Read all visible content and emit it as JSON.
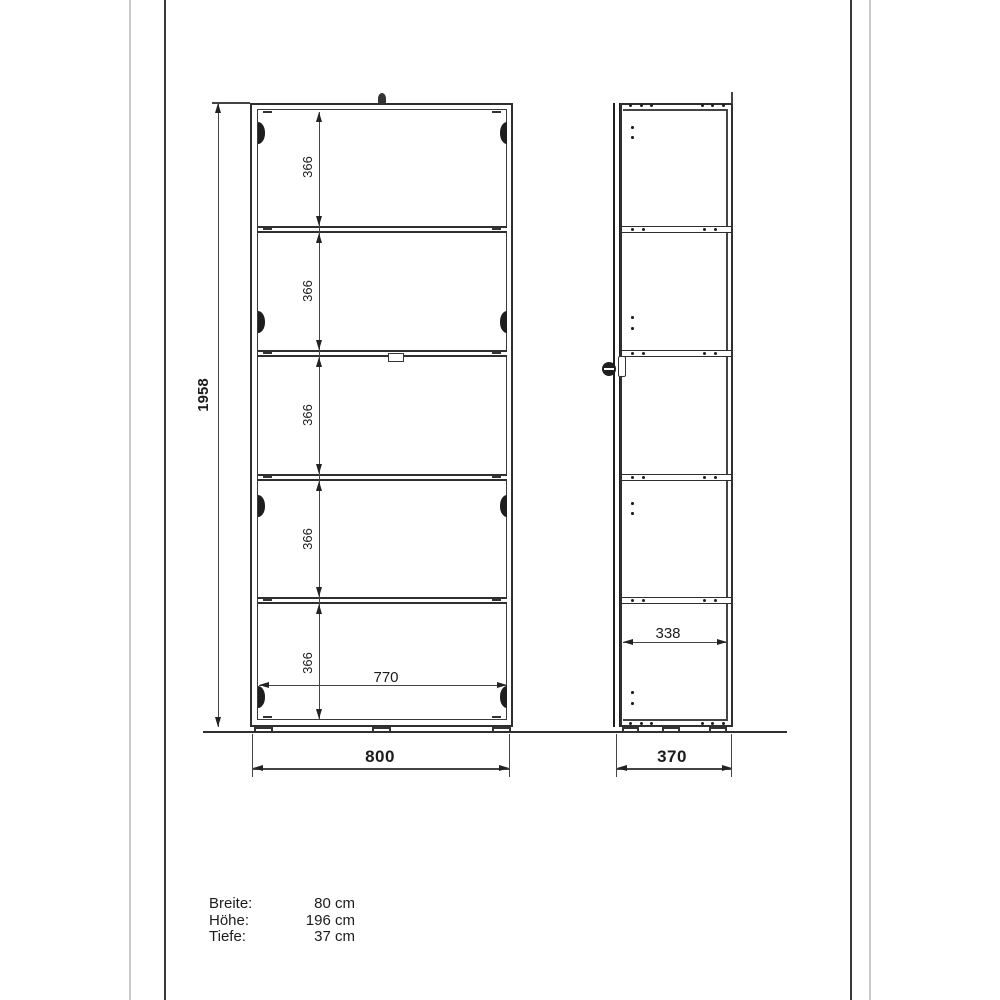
{
  "sheet": {
    "front_view": {
      "height_mm": "1958",
      "shelf_spacing_mm": [
        "366",
        "366",
        "366",
        "366",
        "366"
      ],
      "inner_width_mm": "770",
      "outer_width_mm": "800"
    },
    "side_view": {
      "inner_depth_mm": "338",
      "outer_depth_mm": "370"
    },
    "specs": {
      "rows": [
        {
          "label": "Breite:",
          "value": "80 cm"
        },
        {
          "label": "Höhe:",
          "value": "196 cm"
        },
        {
          "label": "Tiefe:",
          "value": "37 cm"
        }
      ]
    },
    "colors": {
      "line": "#2f2f2f",
      "frame_dark": "#3a3a3a",
      "frame_light": "#c9c9c9",
      "background": "#ffffff"
    }
  }
}
